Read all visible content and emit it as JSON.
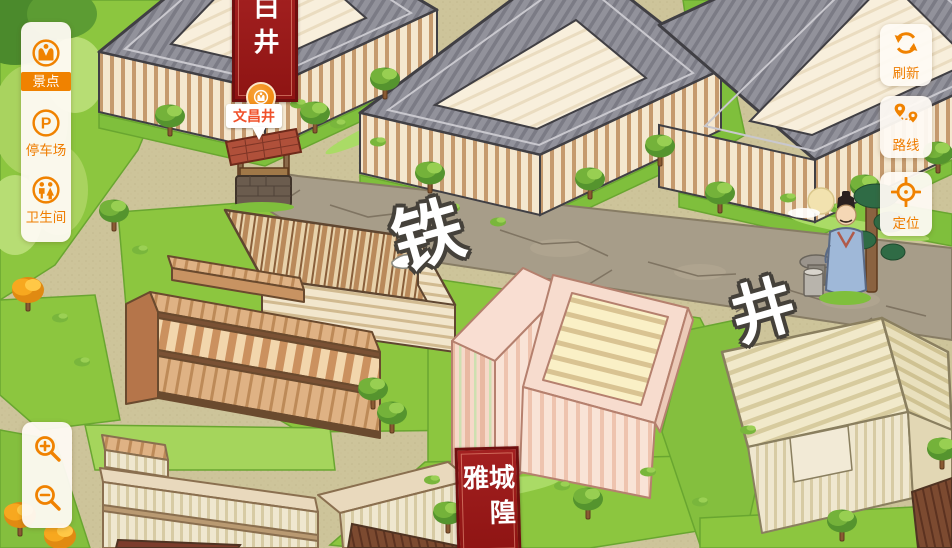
{
  "map": {
    "poi": {
      "label": "文昌井"
    },
    "banner_top": {
      "text": "白井"
    },
    "banner_bottom": {
      "text": "城隍雅"
    },
    "street_labels": [
      "铁",
      "井"
    ]
  },
  "left_menu": {
    "items": [
      {
        "id": "scenic",
        "label": "景点",
        "active": true
      },
      {
        "id": "parking",
        "label": "停车场",
        "active": false
      },
      {
        "id": "toilet",
        "label": "卫生间",
        "active": false
      }
    ]
  },
  "right_menu": {
    "refresh": {
      "label": "刷新"
    },
    "route": {
      "label": "路线"
    },
    "locate": {
      "label": "定位"
    }
  },
  "colors": {
    "accent": "#f08200",
    "banner_red": "#9d1b1b",
    "panel_bg": "#fdf8f0",
    "grass": "#8cc63f",
    "road": "#a79d89"
  }
}
